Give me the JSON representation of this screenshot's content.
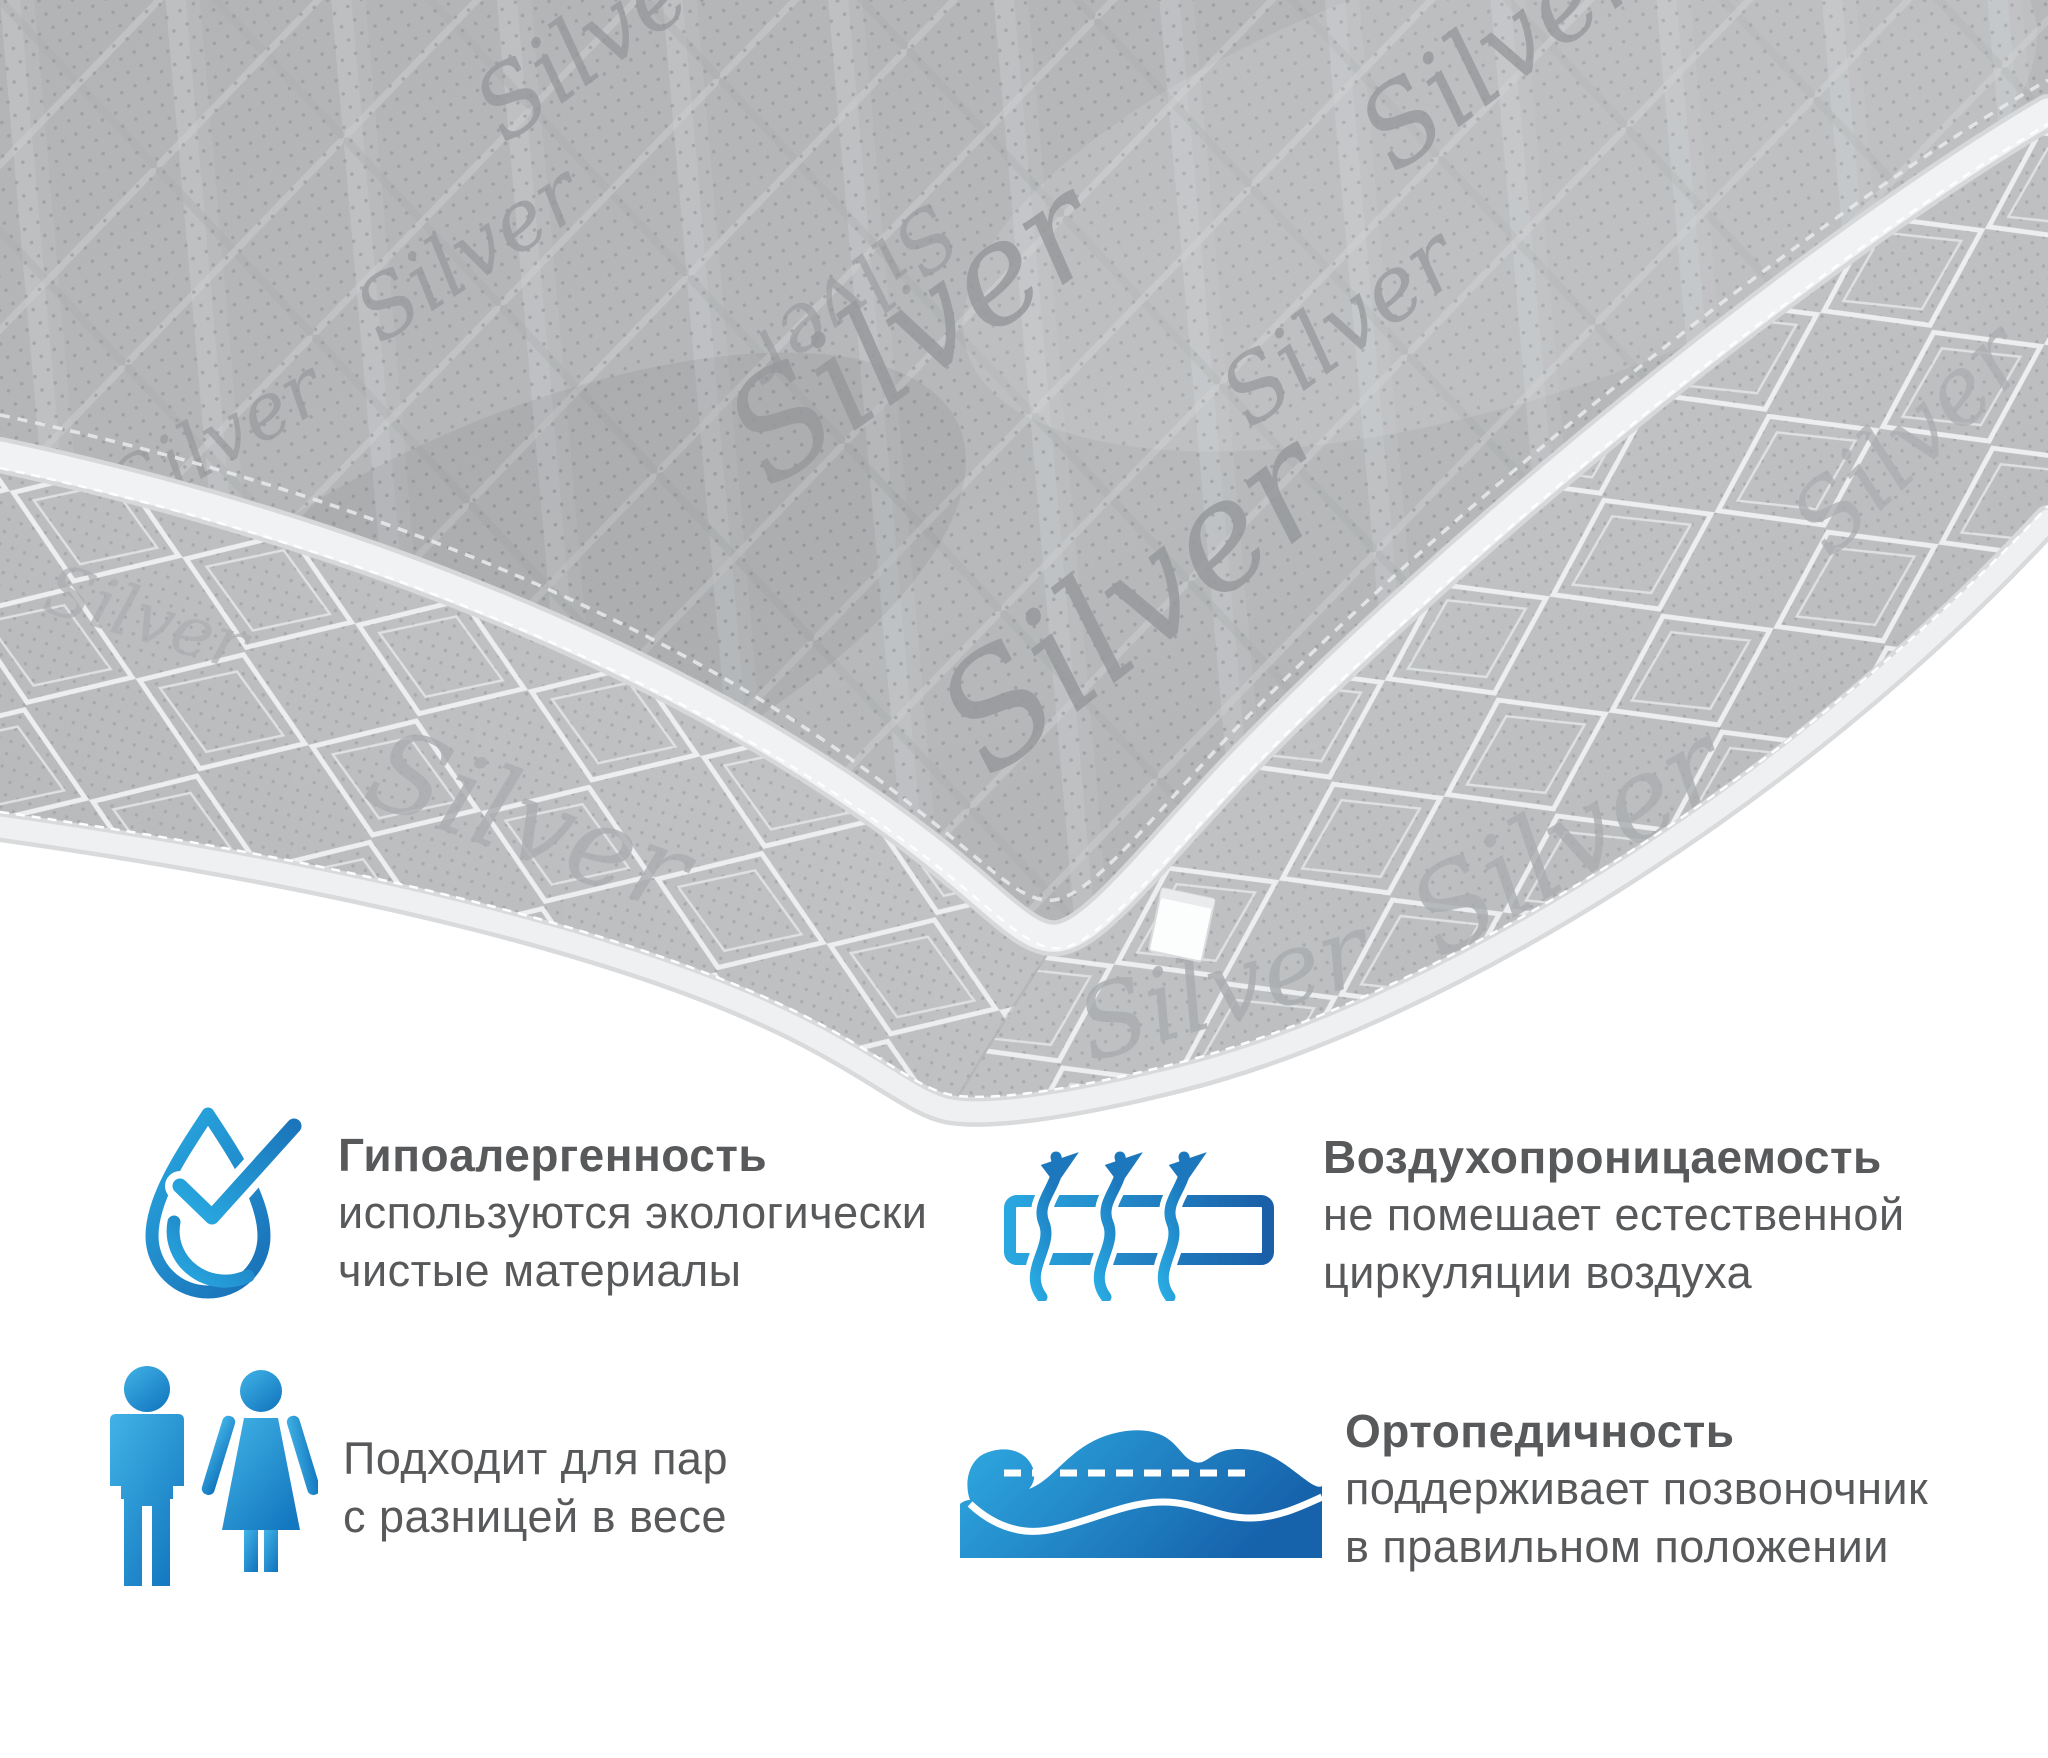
{
  "mattress": {
    "fabric_script": "Silver"
  },
  "features": {
    "hypoallergenic": {
      "title": "Гипоалергенность",
      "line1": "используются экологически",
      "line2": "чистые материалы"
    },
    "breathability": {
      "title": "Воздухопроницаемость",
      "line1": "не помешает естественной",
      "line2": "циркуляции воздуха"
    },
    "couples": {
      "line1": "Подходит для пар",
      "line2": "с разницей в весе"
    },
    "orthopedic": {
      "title": "Ортопедичность",
      "line1": "поддерживает позвоночник",
      "line2": "в правильном положении"
    }
  },
  "colors": {
    "accent_blue_light": "#29ABE2",
    "accent_blue_dark": "#1B75BB",
    "text_gray": "#58595B",
    "fabric_gray": "#B5B7B9",
    "side_panel_gray": "#C7C9CB",
    "piping_white": "#F1F2F3"
  }
}
